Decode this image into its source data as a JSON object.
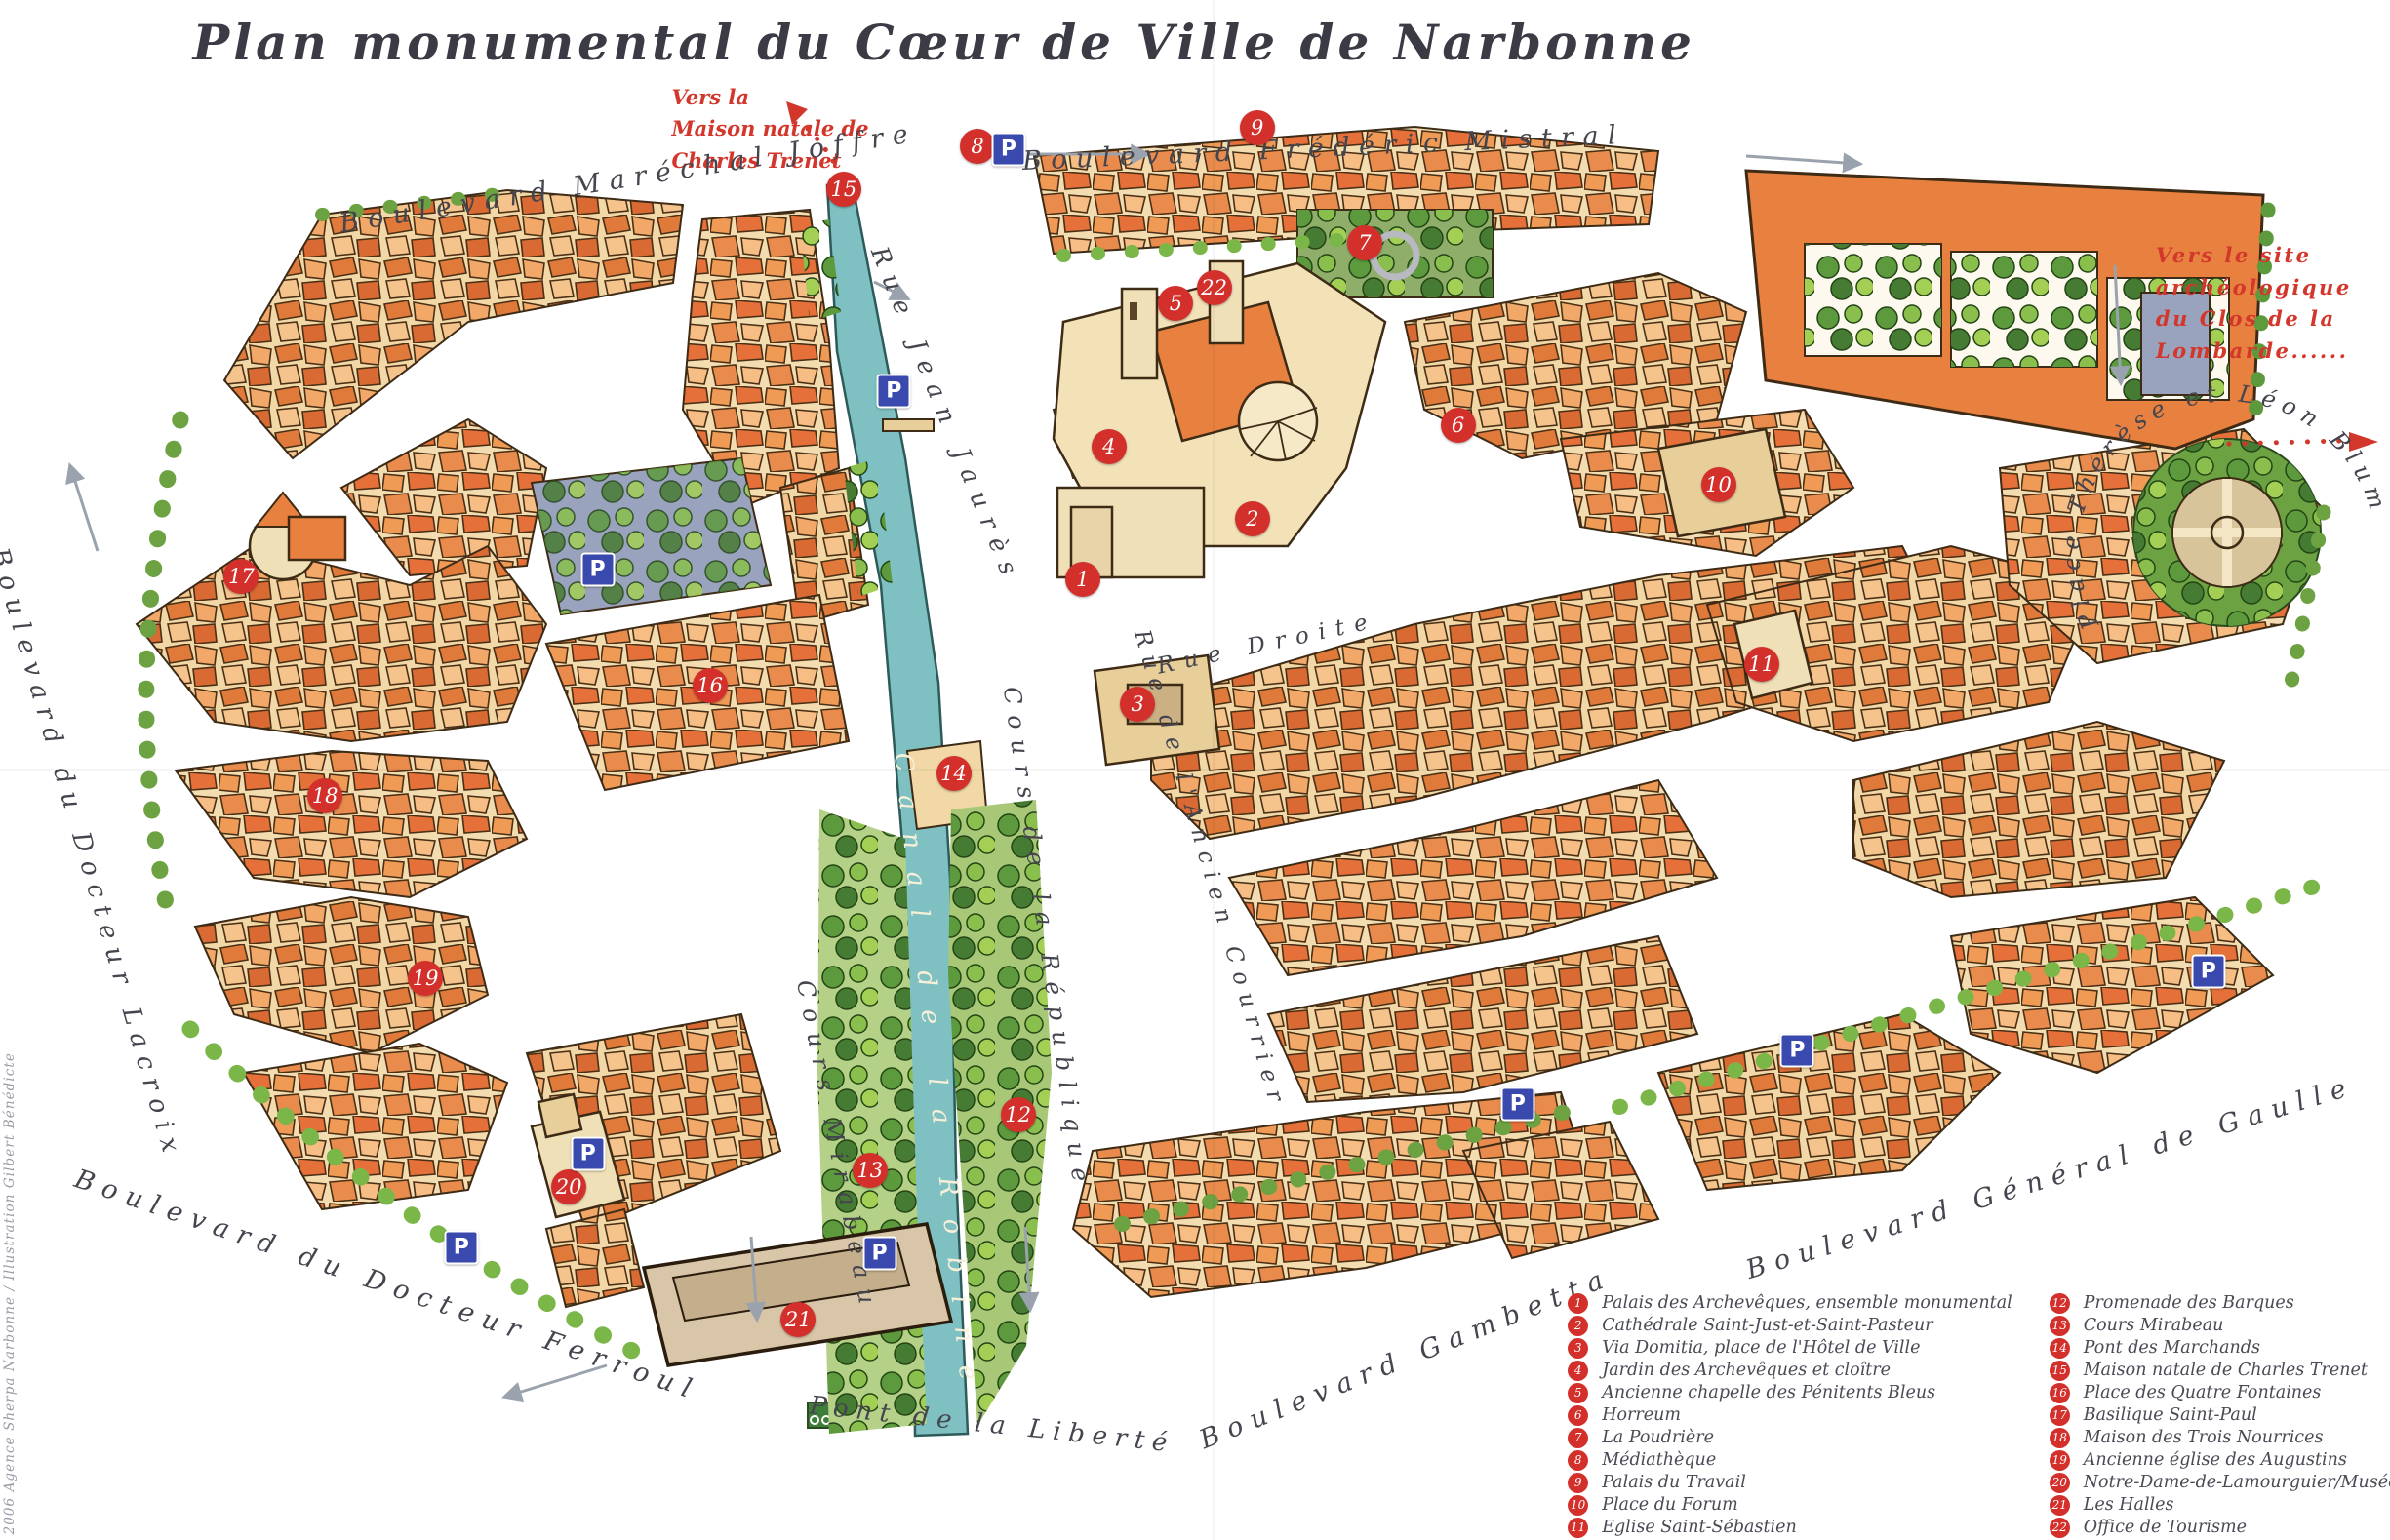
{
  "title": "Plan monumental du Cœur de Ville de Narbonne",
  "credit": "2006 Agence Sherpa Narbonne / Illustration Gilbert Bénédicte",
  "colors": {
    "marker_red": "#d3302c",
    "parking_blue": "#3a49ae",
    "canal_teal": "#7fc1c2",
    "street_text": "#45454f",
    "canal_text": "#f7f0d8",
    "annotation_red": "#d3372c",
    "title_text": "#3b3b45"
  },
  "annotations": {
    "trenet": {
      "lines": [
        "Vers la",
        "Maison natale de",
        "Charles Trenet"
      ]
    },
    "lombarde": {
      "lines": [
        "Vers le site",
        "archéologique",
        "du Clos de la",
        "Lombarde......"
      ]
    }
  },
  "map": {
    "parking_label": "P",
    "markers": [
      {
        "n": "1",
        "x": 45.3,
        "y": 37.6
      },
      {
        "n": "2",
        "x": 52.4,
        "y": 33.7
      },
      {
        "n": "3",
        "x": 47.6,
        "y": 45.7
      },
      {
        "n": "4",
        "x": 46.4,
        "y": 29.0
      },
      {
        "n": "5",
        "x": 49.2,
        "y": 19.7
      },
      {
        "n": "6",
        "x": 61.0,
        "y": 27.6
      },
      {
        "n": "7",
        "x": 57.1,
        "y": 15.8
      },
      {
        "n": "8",
        "x": 40.9,
        "y": 9.5
      },
      {
        "n": "9",
        "x": 52.6,
        "y": 8.3
      },
      {
        "n": "10",
        "x": 71.9,
        "y": 31.5
      },
      {
        "n": "11",
        "x": 73.7,
        "y": 43.1
      },
      {
        "n": "12",
        "x": 42.6,
        "y": 72.4
      },
      {
        "n": "13",
        "x": 36.4,
        "y": 76.0
      },
      {
        "n": "14",
        "x": 39.9,
        "y": 50.2
      },
      {
        "n": "15",
        "x": 35.3,
        "y": 12.3
      },
      {
        "n": "16",
        "x": 29.7,
        "y": 44.5
      },
      {
        "n": "17",
        "x": 10.1,
        "y": 37.4
      },
      {
        "n": "18",
        "x": 13.6,
        "y": 51.7
      },
      {
        "n": "19",
        "x": 17.8,
        "y": 63.5
      },
      {
        "n": "20",
        "x": 23.8,
        "y": 77.1
      },
      {
        "n": "21",
        "x": 33.4,
        "y": 85.7
      },
      {
        "n": "22",
        "x": 50.8,
        "y": 18.7
      }
    ],
    "parking": [
      {
        "x": 42.2,
        "y": 9.7
      },
      {
        "x": 37.4,
        "y": 25.4
      },
      {
        "x": 25.0,
        "y": 37.0
      },
      {
        "x": 24.6,
        "y": 74.9
      },
      {
        "x": 19.3,
        "y": 81.0
      },
      {
        "x": 36.8,
        "y": 81.4
      },
      {
        "x": 63.5,
        "y": 71.7
      },
      {
        "x": 75.2,
        "y": 68.2
      },
      {
        "x": 92.4,
        "y": 63.1
      }
    ],
    "streets": [
      {
        "id": "bd-marechal-joffre",
        "label": "Boulevard Maréchal Joffre",
        "x": 26.3,
        "y": 11.6,
        "rot": -9,
        "size": 27,
        "ls": 0.35
      },
      {
        "id": "bd-frederic-mistral",
        "label": "Boulevard Frédéric Mistral",
        "x": 55.4,
        "y": 9.6,
        "rot": -2.5,
        "size": 27,
        "ls": 0.35
      },
      {
        "id": "rue-jean-jaures",
        "label": "Rue Jean Jaurès",
        "x": 39.6,
        "y": 27.0,
        "rot": 68,
        "size": 25,
        "ls": 0.45
      },
      {
        "id": "cours-de-la-republique",
        "label": "Cours de la République",
        "x": 43.8,
        "y": 61.0,
        "rot": 82,
        "size": 24,
        "ls": 0.45
      },
      {
        "id": "canal-de-la-robine",
        "label": "Canal de la Robine",
        "x": 39.2,
        "y": 70.0,
        "rot": 84,
        "size": 26,
        "ls": 0.9,
        "canal": true
      },
      {
        "id": "cours-mirabeau",
        "label": "Cours Mirabeau",
        "x": 35.0,
        "y": 74.5,
        "rot": 79,
        "size": 24,
        "ls": 0.45
      },
      {
        "id": "rue-droite",
        "label": "Rue Droite",
        "x": 53.0,
        "y": 41.8,
        "rot": -12,
        "size": 23,
        "ls": 0.45
      },
      {
        "id": "rue-ancien-courrier",
        "label": "Rue de l'Ancien Courrier",
        "x": 50.6,
        "y": 56.5,
        "rot": 74,
        "size": 23,
        "ls": 0.4
      },
      {
        "id": "bd-gambetta",
        "label": "Boulevard Gambetta",
        "x": 58.8,
        "y": 88.2,
        "rot": -22,
        "size": 27,
        "ls": 0.35
      },
      {
        "id": "bd-general-de-gaulle",
        "label": "Boulevard Général de Gaulle",
        "x": 85.8,
        "y": 76.5,
        "rot": -17,
        "size": 27,
        "ls": 0.35
      },
      {
        "id": "bd-docteur-lacroix",
        "label": "Boulevard du Docteur Lacroix",
        "x": 3.6,
        "y": 55.5,
        "rot": 74,
        "size": 26,
        "ls": 0.35
      },
      {
        "id": "bd-docteur-ferroul",
        "label": "Boulevard du Docteur Ferroul",
        "x": 16.2,
        "y": 83.5,
        "rot": 19,
        "size": 27,
        "ls": 0.35
      },
      {
        "id": "pont-de-la-liberte",
        "label": "Pont de la Liberté",
        "x": 41.5,
        "y": 92.5,
        "rot": 6,
        "size": 26,
        "ls": 0.3
      }
    ],
    "curved_street": {
      "id": "place-therese-leon-blum",
      "label": "Place Thérèse et Léon Blum"
    }
  },
  "legend": {
    "left": [
      {
        "n": "1",
        "label": "Palais des Archevêques, ensemble monumental"
      },
      {
        "n": "2",
        "label": "Cathédrale Saint-Just-et-Saint-Pasteur"
      },
      {
        "n": "3",
        "label": "Via Domitia, place de l'Hôtel de Ville"
      },
      {
        "n": "4",
        "label": "Jardin des Archevêques et cloître"
      },
      {
        "n": "5",
        "label": "Ancienne chapelle des Pénitents Bleus"
      },
      {
        "n": "6",
        "label": "Horreum"
      },
      {
        "n": "7",
        "label": "La Poudrière"
      },
      {
        "n": "8",
        "label": "Médiathèque"
      },
      {
        "n": "9",
        "label": "Palais du Travail"
      },
      {
        "n": "10",
        "label": "Place du Forum"
      },
      {
        "n": "11",
        "label": "Eglise Saint-Sébastien"
      }
    ],
    "right": [
      {
        "n": "12",
        "label": "Promenade des Barques"
      },
      {
        "n": "13",
        "label": "Cours Mirabeau"
      },
      {
        "n": "14",
        "label": "Pont des Marchands"
      },
      {
        "n": "15",
        "label": "Maison natale de Charles Trenet"
      },
      {
        "n": "16",
        "label": "Place des Quatre Fontaines"
      },
      {
        "n": "17",
        "label": "Basilique Saint-Paul"
      },
      {
        "n": "18",
        "label": "Maison des Trois Nourrices"
      },
      {
        "n": "19",
        "label": "Ancienne église des Augustins"
      },
      {
        "n": "20",
        "label": "Notre-Dame-de-Lamourguier/Musée lapidaire"
      },
      {
        "n": "21",
        "label": "Les Halles"
      },
      {
        "n": "22",
        "label": "Office de Tourisme"
      }
    ]
  }
}
